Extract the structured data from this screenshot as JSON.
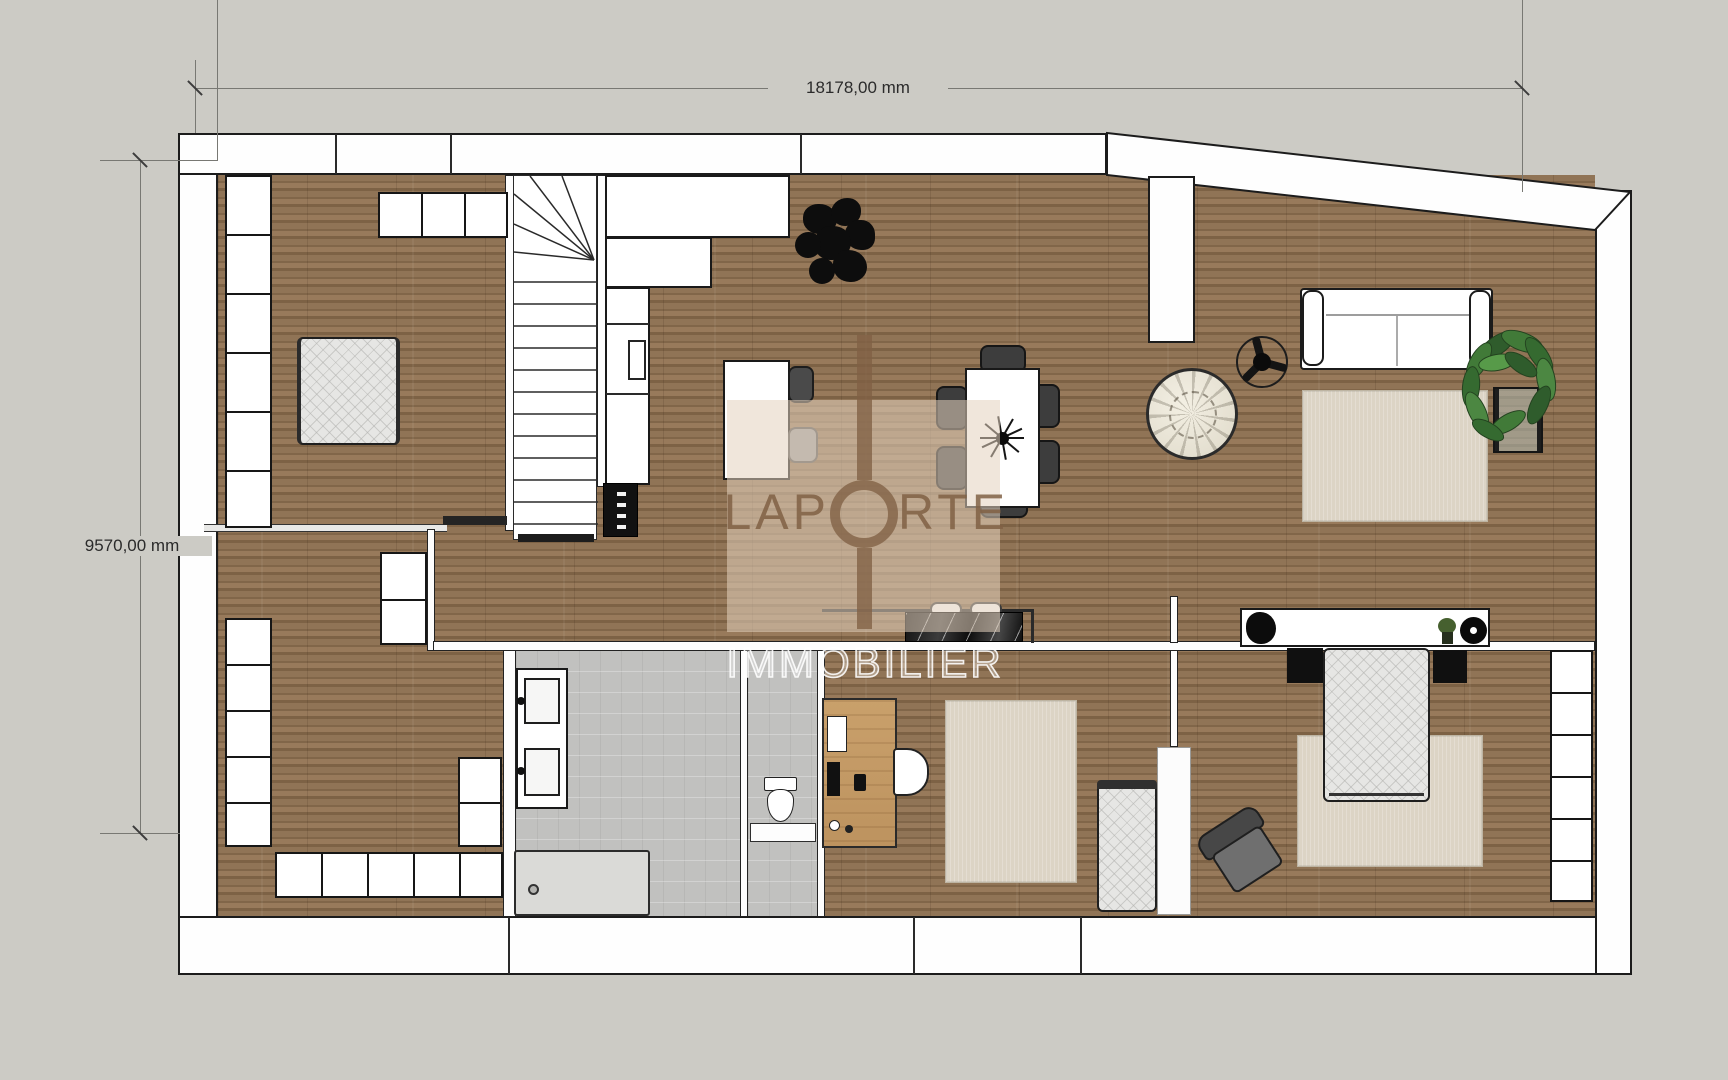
{
  "annotations": {
    "width_dimension": "18178,00 mm",
    "height_dimension": "9570,00 mm"
  },
  "watermark": {
    "brand_left": "LAP",
    "brand_right": "RTE",
    "brand_word": "LAPORTE",
    "subtitle": "IMMOBILIER"
  },
  "palette": {
    "exterior_gray": "#cccbc5",
    "wall_white": "#fefefe",
    "outline_black": "#1c1c1c",
    "wood_floor": "#8a6e51",
    "bathroom_tile": "#c1c1bf",
    "rug_beige": "#dcd4c5",
    "watermark_beige": "#e3d2bd",
    "watermark_brown": "#806044",
    "plant_green": "#417a38"
  },
  "icons": {
    "keyhole-logo-icon": "circle-with-stem",
    "ceiling-fan-icon": "three-blade-fan",
    "plant-silhouette-icon": "black-foliage-blob",
    "potted-plant-icon": "green-leaves-square-pot"
  }
}
